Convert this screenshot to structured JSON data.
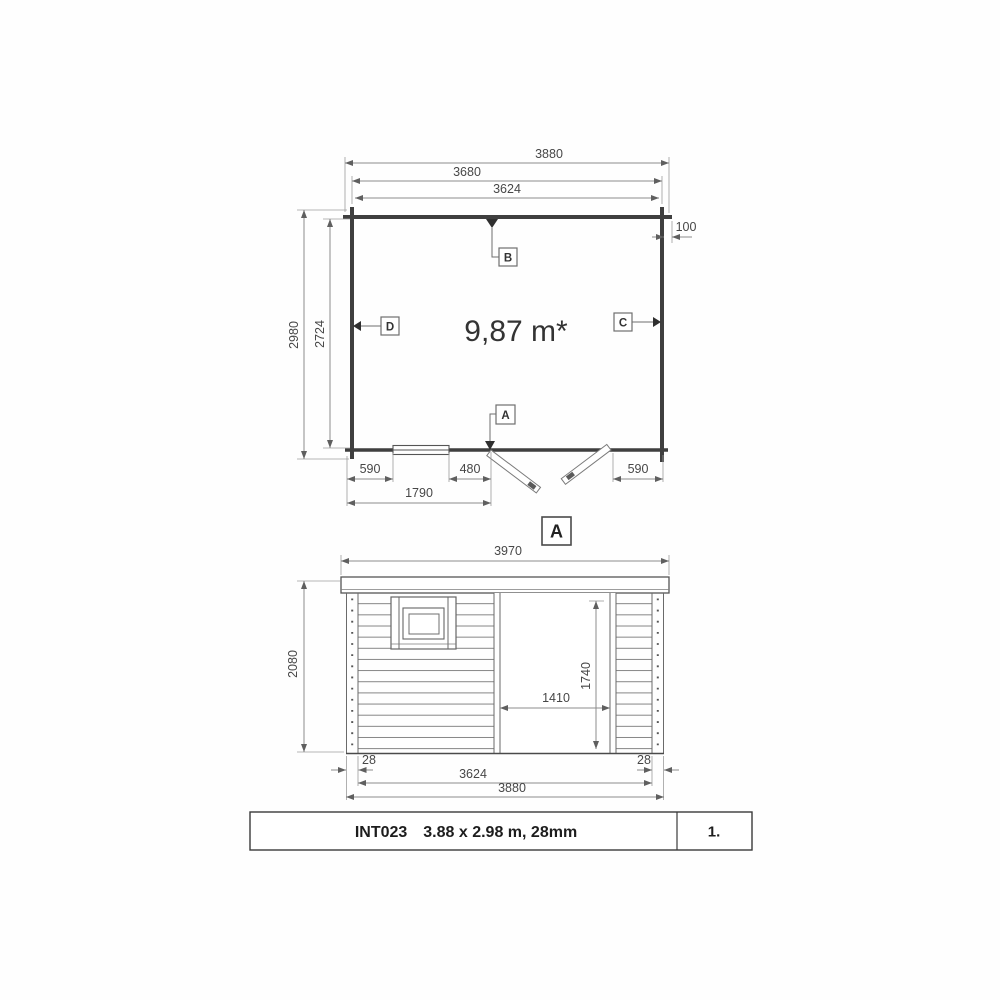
{
  "floor_plan": {
    "area_label": "9,87 m*",
    "marker_a": "A",
    "marker_b": "B",
    "marker_c": "C",
    "marker_d": "D",
    "dim_overall_width": "3880",
    "dim_log_length": "3680",
    "dim_inner_width": "3624",
    "dim_roof_overhang": "100",
    "dim_overall_depth": "2980",
    "dim_inner_depth": "2724",
    "dim_wall_to_window": "590",
    "dim_window_to_door": "480",
    "dim_door_to_wall": "590",
    "dim_wall_to_door": "1790"
  },
  "section": {
    "label": "A"
  },
  "elevation": {
    "dim_roof_width": "3970",
    "dim_wall_height": "2080",
    "dim_door_height": "1740",
    "dim_door_width": "1410",
    "dim_corner_left": "28",
    "dim_corner_right": "28",
    "dim_log_wall_length": "3624",
    "dim_overall_width": "3880"
  },
  "title_block": {
    "model_code": "INT023",
    "model_size": "3.88 x 2.98 m, 28mm",
    "page_number": "1."
  }
}
